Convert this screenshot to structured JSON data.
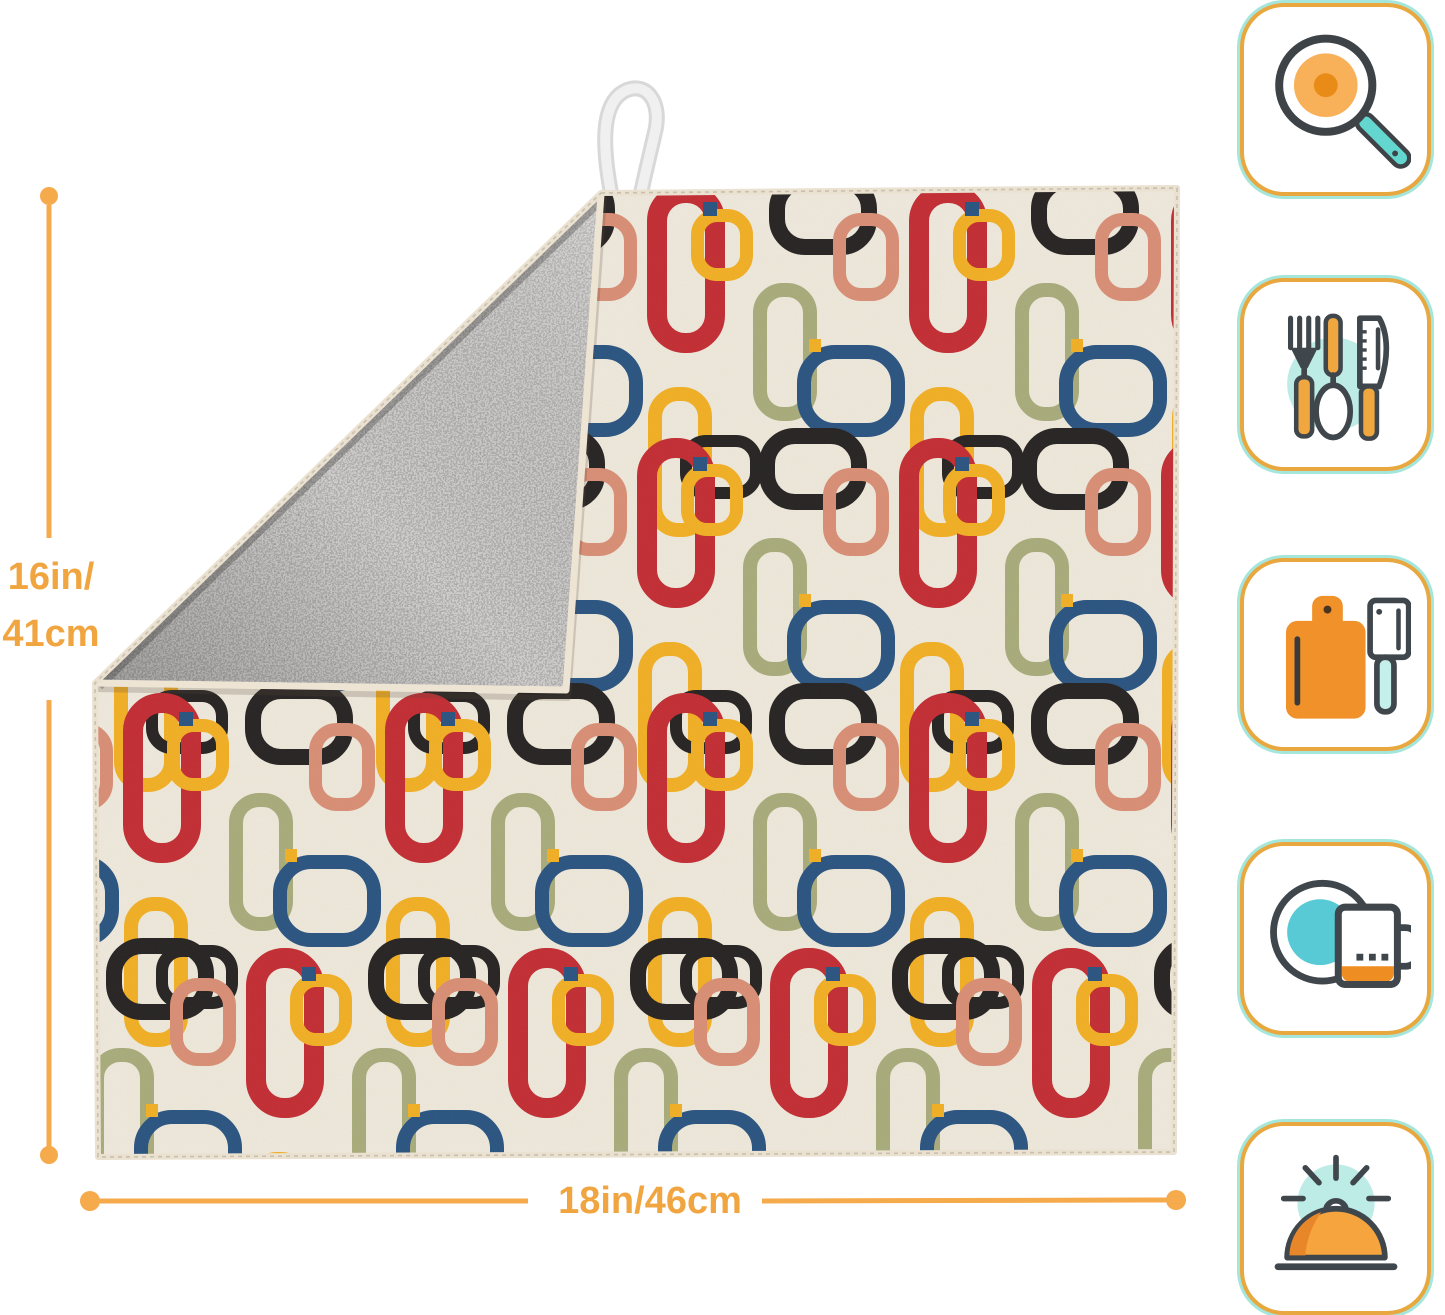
{
  "page": {
    "background": "#ffffff"
  },
  "dimensions": {
    "height_line1": "16in/",
    "height_line2": "41cm",
    "width": "18in/46cm",
    "line_color": "#F5AA4C",
    "text_color": "#F1A540"
  },
  "product": {
    "type": "dish-drying-mat",
    "front_color": "#EFE9DB",
    "backing_color": "#C6C4C0",
    "binding_color": "#EAE1D0",
    "loop_color": "#EDEDED"
  },
  "mat_pattern": {
    "colors": {
      "red": "#C2282E",
      "yellow": "#F3AE1E",
      "black": "#211E1D",
      "olive": "#A7AA78",
      "navy": "#25507E",
      "salmon": "#D98C72"
    },
    "grid": {
      "x0": 123,
      "y0": 183,
      "dx": 262,
      "dy": 255,
      "rows": 4,
      "cols": 5,
      "row_offsets": [
        0,
        -10,
        0,
        123
      ]
    },
    "cell": [
      {
        "t": "ring",
        "c": "red",
        "x": 0,
        "y": 0,
        "w": 78,
        "h": 170,
        "sw": 20,
        "rx": 38
      },
      {
        "t": "ring",
        "c": "yellow",
        "x": 44,
        "y": 26,
        "w": 62,
        "h": 72,
        "sw": 13,
        "rx": 26
      },
      {
        "t": "tick",
        "c": "navy",
        "x": 56,
        "y": 19,
        "w": 14,
        "h": 14
      },
      {
        "t": "ring",
        "c": "black",
        "x": 122,
        "y": -10,
        "w": 108,
        "h": 82,
        "sw": 16,
        "rx": 36
      },
      {
        "t": "ring",
        "c": "salmon",
        "x": 186,
        "y": 30,
        "w": 66,
        "h": 88,
        "sw": 13,
        "rx": 28
      },
      {
        "t": "ring",
        "c": "olive",
        "x": 106,
        "y": 100,
        "w": 64,
        "h": 138,
        "sw": 14,
        "rx": 30
      },
      {
        "t": "ring",
        "c": "navy",
        "x": 150,
        "y": 162,
        "w": 108,
        "h": 92,
        "sw": 14,
        "rx": 38
      },
      {
        "t": "tick",
        "c": "yellow",
        "x": 162,
        "y": 156,
        "w": 12,
        "h": 13
      },
      {
        "t": "ring",
        "c": "yellow",
        "x": 1,
        "y": 204,
        "w": 64,
        "h": 150,
        "sw": 14,
        "rx": 30
      },
      {
        "t": "ring",
        "c": "black",
        "x": 33,
        "y": 252,
        "w": 82,
        "h": 64,
        "sw": 12,
        "rx": 26
      }
    ]
  },
  "feature_icons": [
    {
      "name": "frying-pan-icon"
    },
    {
      "name": "cutlery-icon"
    },
    {
      "name": "cutting-board-icon"
    },
    {
      "name": "plate-and-mug-icon"
    },
    {
      "name": "serving-dome-icon"
    }
  ],
  "icon_style": {
    "badge_border_orange": "#E9A83F",
    "badge_border_mint": "#A5E6DC",
    "line_dark": "#3F474C",
    "accent_orange": "#F0A73F",
    "accent_orange_deep": "#E8872A",
    "teal": "#63D6D0",
    "teal_light": "#BDEBE6"
  }
}
